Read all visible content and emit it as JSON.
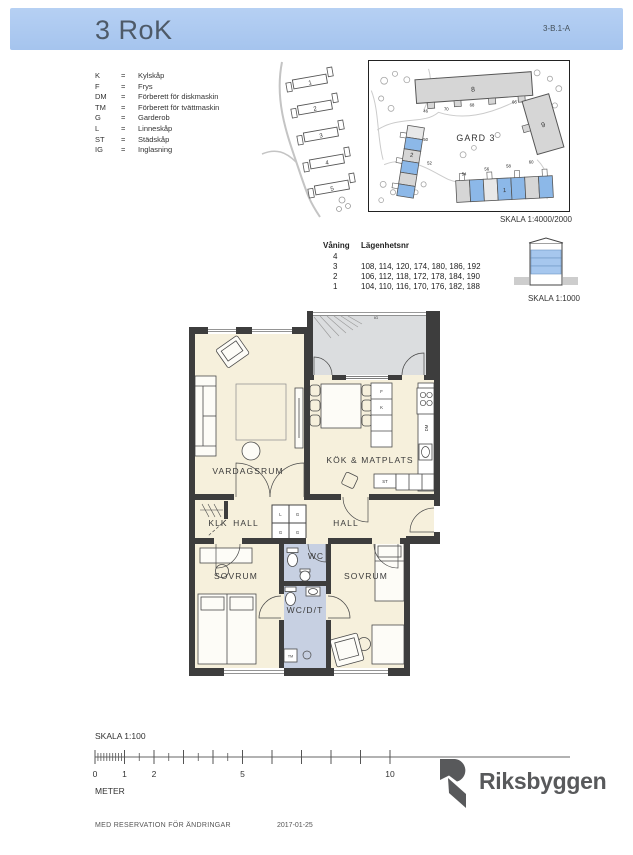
{
  "header": {
    "title": "3 RoK",
    "code": "3-B.1-A"
  },
  "legend": {
    "eq": "=",
    "items": [
      {
        "abbr": "K",
        "desc": "Kylskåp"
      },
      {
        "abbr": "F",
        "desc": "Frys"
      },
      {
        "abbr": "DM",
        "desc": "Förberett för diskmaskin"
      },
      {
        "abbr": "TM",
        "desc": "Förberett för tvättmaskin"
      },
      {
        "abbr": "G",
        "desc": "Garderob"
      },
      {
        "abbr": "L",
        "desc": "Linneskåp"
      },
      {
        "abbr": "ST",
        "desc": "Städskåp"
      },
      {
        "abbr": "IG",
        "desc": "Inglasning"
      }
    ]
  },
  "site_overview": {
    "building_numbers": [
      "1",
      "2",
      "3",
      "4",
      "5"
    ]
  },
  "site_detail": {
    "area_label": "GARD 3",
    "buildings": {
      "b8": "8",
      "b9": "9",
      "b2": "2",
      "b1": "1"
    },
    "entrance_numbers": [
      "46",
      "70",
      "68",
      "66",
      "50",
      "52",
      "54",
      "56",
      "58",
      "60"
    ],
    "scale_label": "SKALA 1:4000/2000"
  },
  "apartments": {
    "floor_col": "Våning",
    "apt_col": "Lägenhetsnr",
    "rows": [
      {
        "floor": "4",
        "numbers": ""
      },
      {
        "floor": "3",
        "numbers": "108, 114, 120, 174, 180, 186, 192"
      },
      {
        "floor": "2",
        "numbers": "106, 112, 118, 172, 178, 184, 190"
      },
      {
        "floor": "1",
        "numbers": "104, 110, 116, 170, 176, 182, 188"
      }
    ],
    "scale_label": "SKALA 1:1000"
  },
  "plan": {
    "rooms": {
      "vardagsrum": "VARDAGSRUM",
      "kok_matplats": "KÖK & MATPLATS",
      "hall_left": "HALL",
      "hall_right": "HALL",
      "klk": "KLK",
      "wc": "WC",
      "sovrum_left": "SOVRUM",
      "sovrum_right": "SOVRUM",
      "wcdt": "WC/D/T"
    },
    "fixtures": {
      "f": "F",
      "k": "K",
      "st": "ST",
      "dm": "DM",
      "tm": "TM",
      "ig": "IG"
    },
    "wardrobe_cells": [
      "L",
      "G",
      "G",
      "G"
    ]
  },
  "scalebar": {
    "label": "SKALA 1:100",
    "unit": "METER",
    "tick_labels": [
      "0",
      "1",
      "2",
      "5",
      "10"
    ]
  },
  "brand": {
    "name": "Riksbyggen"
  },
  "footer": {
    "note": "MED RESERVATION FÖR ÄNDRINGAR",
    "date": "2017-01-25"
  },
  "colors": {
    "header_bg": "#a9c7ee",
    "wall": "#3d3d3d",
    "floor": "#f6f0dc",
    "balcony": "#dbdddf",
    "wet_room": "#c7d0e2",
    "map_highlight": "#8cb8e8"
  }
}
